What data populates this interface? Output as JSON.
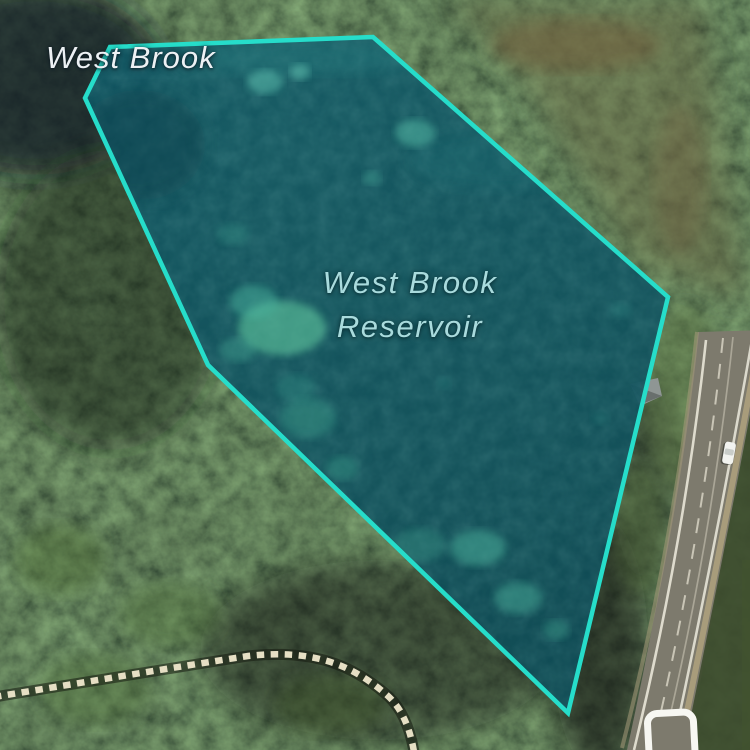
{
  "view": {
    "kind": "satellite-map",
    "width_px": 750,
    "height_px": 750
  },
  "labels": {
    "stream": "West Brook",
    "reservoir_line1": "West Brook",
    "reservoir_line2": "Reservoir"
  },
  "feature": {
    "name": "West Brook Reservoir",
    "shape": "polygon",
    "selected": true
  },
  "icons": [
    {
      "name": "route-shield-icon",
      "shape": "rounded-square-white-outline",
      "note": "partially cut off at bottom edge"
    }
  ],
  "objects": {
    "vehicle": "white car on highway",
    "trail": "dashed footpath through forest",
    "road": "two-lane highway along right side"
  },
  "colors": {
    "accent": "#26ddca",
    "water_fill": "#11525d",
    "label_light": "#edf1f4",
    "label_teal": "#a9dbdd",
    "road_surface": "#7d7a6d",
    "trail_dash": "#e6dfc4"
  }
}
